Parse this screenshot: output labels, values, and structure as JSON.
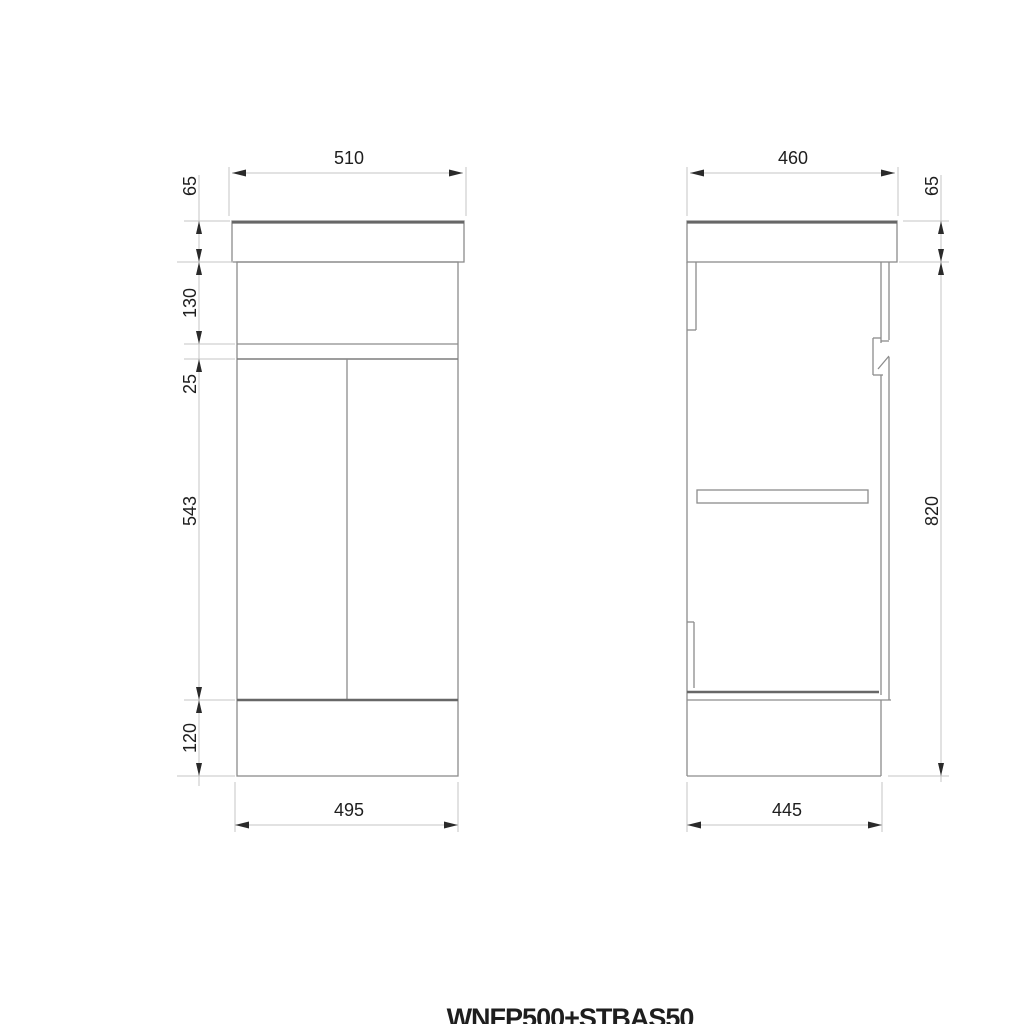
{
  "title": "WNFP500+STBAS50",
  "front_view": {
    "top_width": "510",
    "heights": {
      "basin": "65",
      "drawer": "130",
      "gap": "25",
      "doors": "543",
      "plinth": "120"
    },
    "bottom_width": "495"
  },
  "side_view": {
    "top_depth": "460",
    "heights": {
      "basin": "65",
      "body": "820"
    },
    "bottom_depth": "445"
  },
  "colors": {
    "outline": "#8c8c8c",
    "outline_heavy": "#676767",
    "dimension_line": "#c4c4c4",
    "arrow": "#2a2a2a",
    "text": "#1e1e1e"
  }
}
